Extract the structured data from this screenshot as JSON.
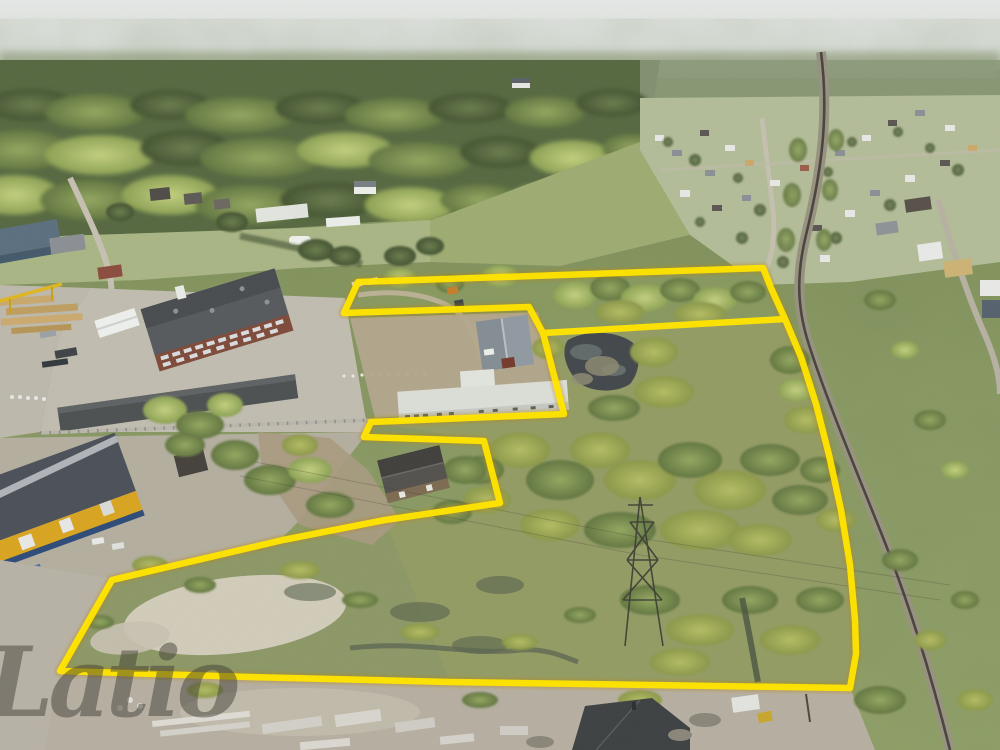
{
  "image": {
    "kind": "aerial-drone-photo",
    "description": "Oblique aerial photo of a rural land plot outlined in yellow, with industrial buildings on the left, a railway and village on the right, forest at the horizon and a construction yard at the bottom",
    "width": 1000,
    "height": 750
  },
  "watermark": {
    "text": "Latio",
    "color": "rgba(62,60,52,0.48)"
  },
  "overlay": {
    "color": "#ffe400",
    "halo_color": "#b8860b",
    "outline_points": "358,282 763,268 771,288 785,319 801,357 816,404 829,455 841,510 850,565 855,620 856,654 850,688 450,682 250,677 60,671 112,580 283,540 385,520 500,503 484,441 364,437 371,422 564,414 543,333 529,307 344,313",
    "divider_points": "543,333 785,319"
  },
  "palette": {
    "sky_top": "#e4e6e5",
    "sky_horizon": "#cfd4cd",
    "distant_haze": "#a3ad93",
    "forest_dark": "#4d5e3b",
    "meadow": "#8a9a62",
    "wetland": "#939b63",
    "pond_water": "#41464a",
    "railway_ballast": "#97917f",
    "dirt_yard": "#bdb8ac",
    "sand_patch": "#d6cfbf",
    "factory_brick": "#7e4938",
    "factory_roof": "#55585c",
    "warehouse_roof": "#9099a1",
    "office_roof": "#dcded8",
    "house_roof": "#4a4745",
    "yellow_wall": "#d9a41e",
    "dark_roof_building": "#3c3f41"
  },
  "scene": {
    "features": [
      "sky-haze",
      "distant-forest",
      "forest-band",
      "village-with-houses",
      "railway-line",
      "industrial-zone",
      "brick-factory",
      "timber-yard",
      "white-tent",
      "gantry-crane",
      "greenhouses",
      "gray-warehouse",
      "white-office-building",
      "brown-farmhouse",
      "yellow-warehouse",
      "pond",
      "willow-groves",
      "wet-meadow",
      "power-pylon",
      "sandy-patch",
      "construction-yard",
      "concrete-materials",
      "dark-roof-building",
      "property-boundary"
    ]
  }
}
